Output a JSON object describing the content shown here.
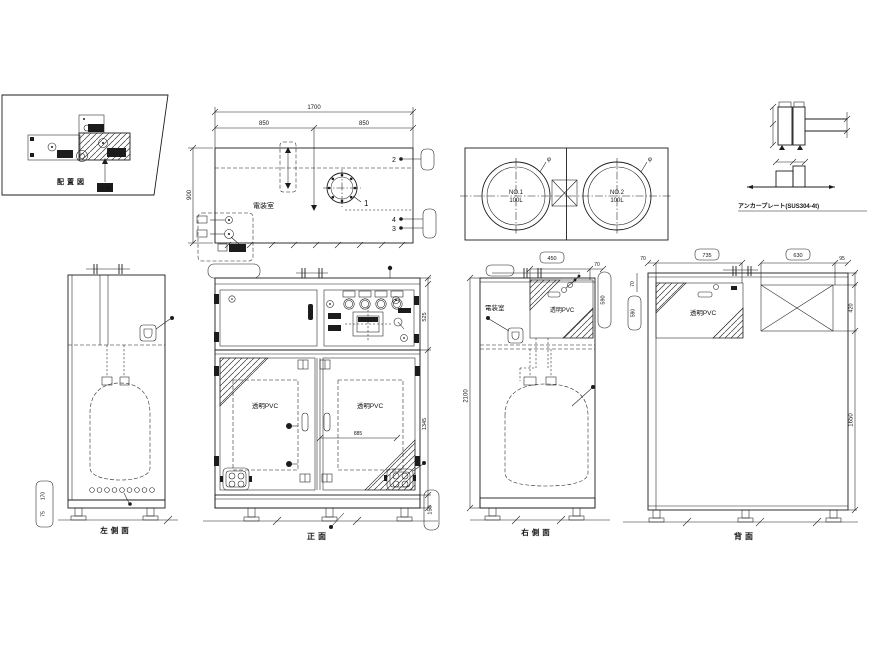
{
  "inset": {
    "caption": "配置図",
    "machine_label": "本機"
  },
  "plan": {
    "dim_total": "1700",
    "dim_left_half": "850",
    "dim_right_half": "850",
    "dim_depth": "900",
    "room": "電装室",
    "balloon1": "1",
    "balloon2": "2",
    "balloon3": "3",
    "balloon4": "4"
  },
  "tanks": {
    "no1": "NO.1",
    "no1_vol": "100L",
    "no2": "NO.2",
    "no2_vol": "100L",
    "phi": "φ"
  },
  "anchor": {
    "caption": "アンカープレート(SUS304-4t)"
  },
  "left_view": {
    "caption": "左側面",
    "tag_dim_a": "170",
    "tag_dim_b": "75"
  },
  "front_view": {
    "caption": "正面",
    "pvc": "透明PVC",
    "dim_upper": "525",
    "dim_lower": "1345",
    "dim_door": "885",
    "tag_base": "150"
  },
  "right_view": {
    "caption": "右側面",
    "room": "電装室",
    "pvc": "透明PVC",
    "dim_window": "450",
    "dim_offset": "70",
    "dim_height": "2100",
    "tag": "590"
  },
  "rear_view": {
    "caption": "背面",
    "pvc": "透明PVC",
    "dim_win_w": "735",
    "dim_panel_w": "630",
    "dim_95": "95",
    "dim_70_top": "70",
    "dim_70_left": "70",
    "dim_panel_h": "420",
    "dim_lower_h": "1650",
    "tag": "590"
  },
  "colors": {
    "line": "#1c1c1c",
    "bg": "#ffffff"
  }
}
